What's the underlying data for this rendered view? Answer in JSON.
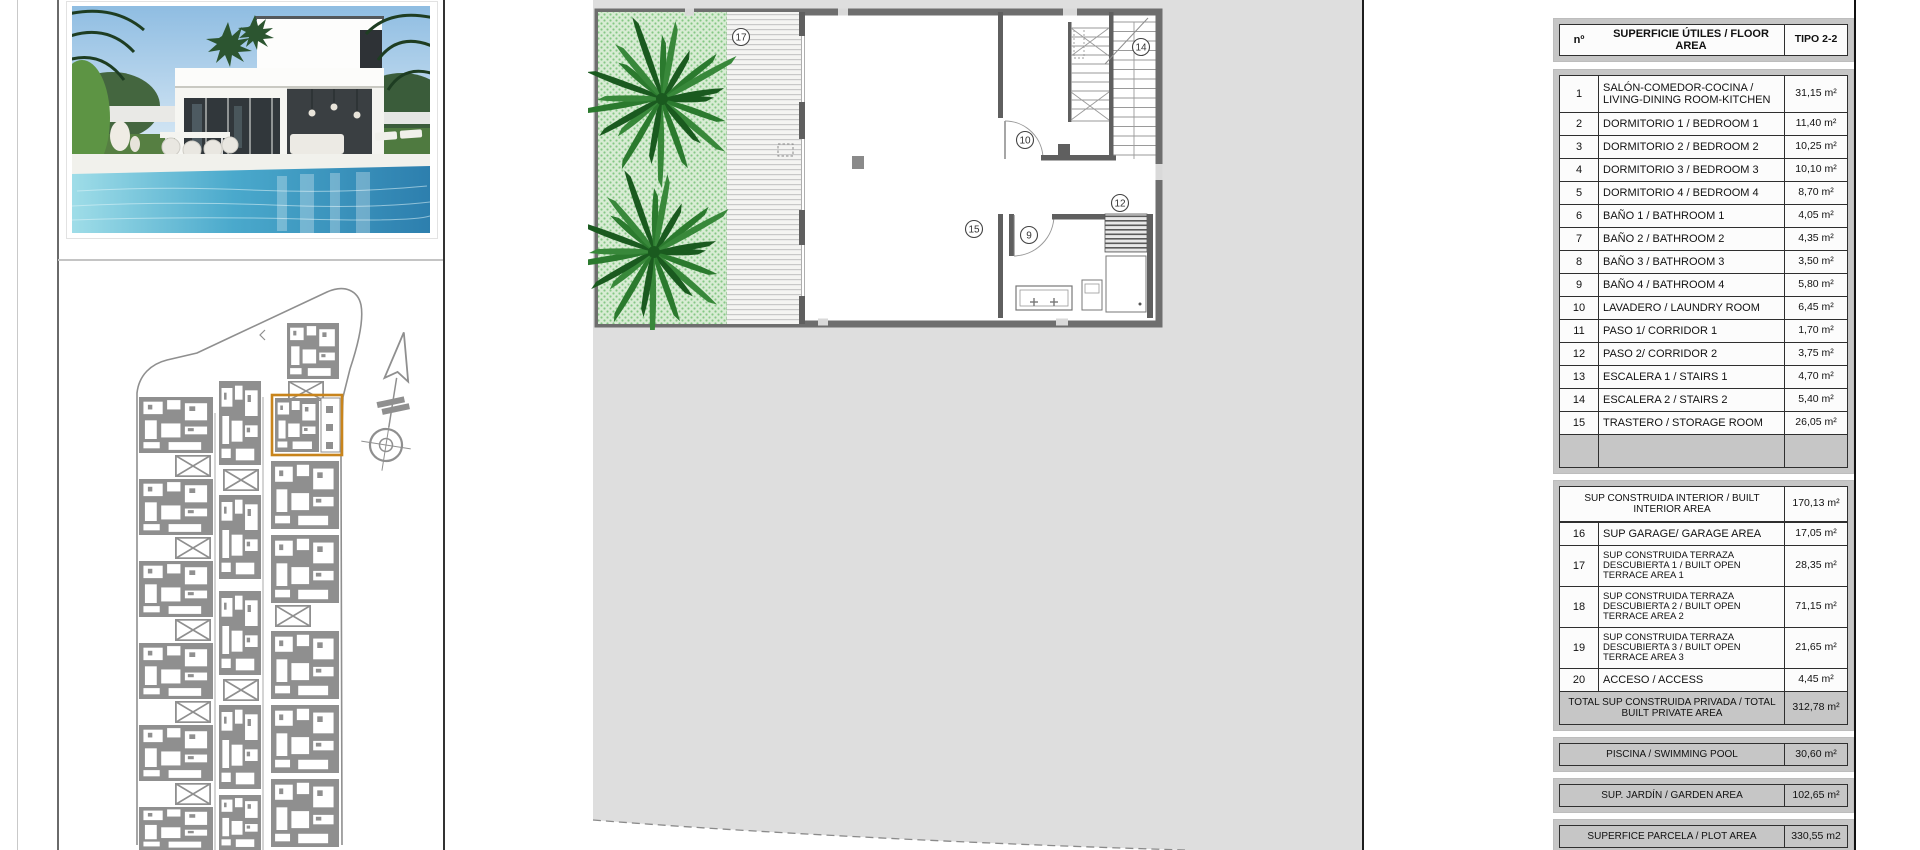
{
  "document": {
    "type_label": "TIPO 2-2",
    "accent_highlight_color": "#c8841c",
    "plot_fill_color": "#dedede",
    "garden_green_color": "#d8ecd4",
    "palm_green_color": "#2b7a2e",
    "siteplan_gray_color": "#8f8f8f"
  },
  "table": {
    "header": {
      "num": "nº",
      "label": "SUPERFICIE ÚTILES / FLOOR AREA",
      "type": "TIPO 2-2"
    },
    "rows": [
      {
        "n": "1",
        "label": "SALÓN-COMEDOR-COCINA / LIVING-DINING ROOM-KITCHEN",
        "value": "31,15 m²"
      },
      {
        "n": "2",
        "label": "DORMITORIO 1 / BEDROOM 1",
        "value": "11,40 m²"
      },
      {
        "n": "3",
        "label": "DORMITORIO 2 / BEDROOM 2",
        "value": "10,25 m²"
      },
      {
        "n": "4",
        "label": "DORMITORIO 3 / BEDROOM 3",
        "value": "10,10 m²"
      },
      {
        "n": "5",
        "label": "DORMITORIO 4 / BEDROOM 4",
        "value": "8,70 m²"
      },
      {
        "n": "6",
        "label": "BAÑO 1 / BATHROOM 1",
        "value": "4,05 m²"
      },
      {
        "n": "7",
        "label": "BAÑO 2 / BATHROOM 2",
        "value": "4,35 m²"
      },
      {
        "n": "8",
        "label": "BAÑO 3 / BATHROOM 3",
        "value": "3,50 m²"
      },
      {
        "n": "9",
        "label": "BAÑO 4 / BATHROOM 4",
        "value": "5,80 m²"
      },
      {
        "n": "10",
        "label": "LAVADERO / LAUNDRY ROOM",
        "value": "6,45 m²"
      },
      {
        "n": "11",
        "label": "PASO 1/ CORRIDOR 1",
        "value": "1,70 m²"
      },
      {
        "n": "12",
        "label": "PASO 2/ CORRIDOR 2",
        "value": "3,75 m²"
      },
      {
        "n": "13",
        "label": "ESCALERA 1 / STAIRS 1",
        "value": "4,70 m²"
      },
      {
        "n": "14",
        "label": "ESCALERA 2 / STAIRS 2",
        "value": "5,40 m²"
      },
      {
        "n": "15",
        "label": "TRASTERO / STORAGE ROOM",
        "value": "26,05 m²"
      }
    ],
    "built_section": {
      "header": {
        "label": "SUP CONSTRUIDA INTERIOR / BUILT INTERIOR AREA",
        "value": "170,13 m²"
      },
      "rows": [
        {
          "n": "16",
          "label": "SUP GARAGE/ GARAGE AREA",
          "value": "17,05 m²"
        },
        {
          "n": "17",
          "label": "SUP CONSTRUIDA TERRAZA DESCUBIERTA 1 / BUILT OPEN TERRACE AREA 1",
          "value": "28,35 m²"
        },
        {
          "n": "18",
          "label": "SUP CONSTRUIDA TERRAZA DESCUBIERTA 2 / BUILT OPEN TERRACE AREA 2",
          "value": "71,15 m²"
        },
        {
          "n": "19",
          "label": "SUP CONSTRUIDA TERRAZA DESCUBIERTA 3 / BUILT OPEN TERRACE AREA 3",
          "value": "21,65 m²"
        },
        {
          "n": "20",
          "label": "ACCESO / ACCESS",
          "value": "4,45 m²"
        }
      ],
      "total": {
        "label": "TOTAL SUP CONSTRUIDA PRIVADA / TOTAL BUILT PRIVATE AREA",
        "value": "312,78 m²"
      }
    },
    "summary_rows": [
      {
        "key": "piscina",
        "label": "PISCINA / SWIMMING POOL",
        "value": "30,60 m²"
      },
      {
        "key": "jardin",
        "label": "SUP. JARDÍN / GARDEN AREA",
        "value": "102,65 m²"
      },
      {
        "key": "parcela",
        "label": "SUPERFICE PARCELA / PLOT AREA",
        "value": "330,55 m2"
      }
    ]
  },
  "floor_plan": {
    "labels": {
      "terrace1": "17",
      "stairs2": "14",
      "laundry": "10",
      "corridor2": "12",
      "storage": "15",
      "bathroom4": "9"
    }
  },
  "site_plan": {
    "highlighted_unit": "selected unit outlined in orange",
    "compass": "north-arrow"
  }
}
